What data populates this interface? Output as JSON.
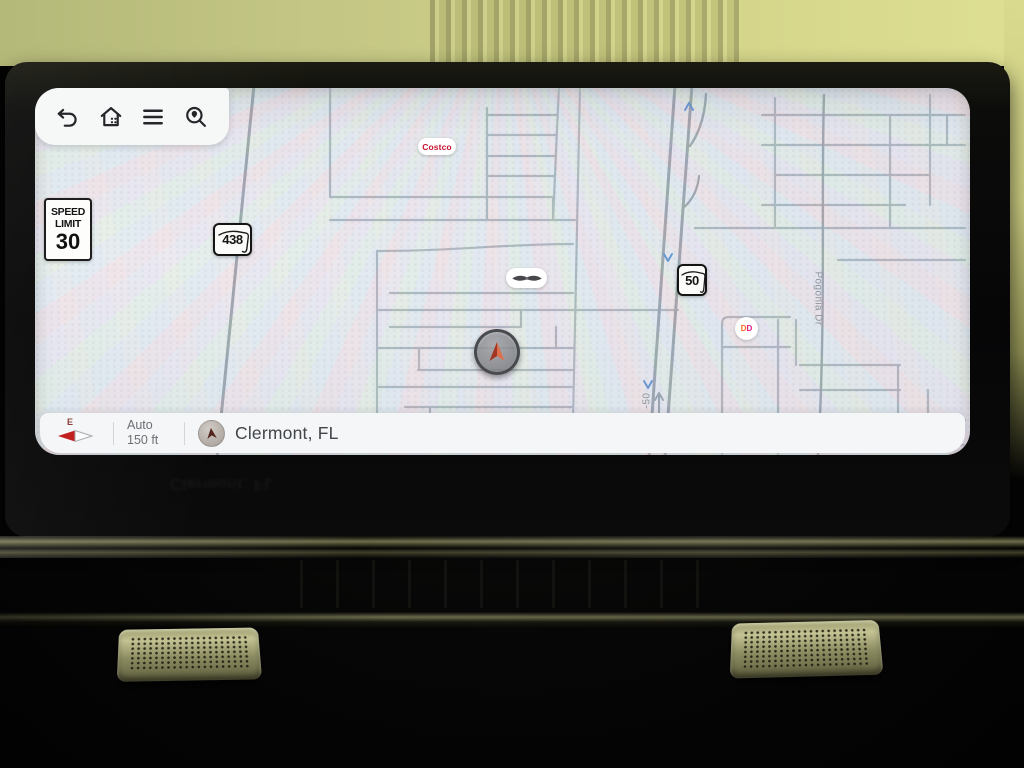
{
  "device": {
    "type": "car-infotainment-navigation"
  },
  "toolbar": {
    "back_icon": "undo-arrow",
    "home_icon": "home",
    "menu_icon": "hamburger-menu",
    "search_icon": "search-location"
  },
  "map": {
    "speed_limit_sign": {
      "line1": "SPEED",
      "line2": "LIMIT",
      "value": "30"
    },
    "route_shields": [
      {
        "id": "fl-438",
        "number": "438"
      },
      {
        "id": "fl-50",
        "number": "50"
      }
    ],
    "poi_labels": [
      {
        "id": "costco",
        "text": "Costco",
        "color": "#c8102e"
      },
      {
        "id": "dealership",
        "icon": "winged-emblem"
      },
      {
        "id": "dunkin",
        "letters": [
          "D",
          "D"
        ],
        "colors": [
          "#ff671f",
          "#da1884"
        ]
      }
    ],
    "street_labels": [
      {
        "text": "Pogonia Dr"
      },
      {
        "text": "-50"
      }
    ],
    "vehicle_marker": {
      "icon": "navigation-arrow",
      "colors": [
        "#a23524",
        "#dd6f4a"
      ]
    }
  },
  "status_bar": {
    "compass": {
      "direction": "E",
      "needle_color": "#c21f1f"
    },
    "zoom_mode": "Auto",
    "scale": "150 ft",
    "location": "Clermont, FL"
  },
  "colors": {
    "map_background": "#e8ebec",
    "road_major": "#97a1a8",
    "road_minor": "#aab4ba",
    "route_arrow_blue": "#5d8fd0",
    "dash_trim": "#c3c394"
  }
}
